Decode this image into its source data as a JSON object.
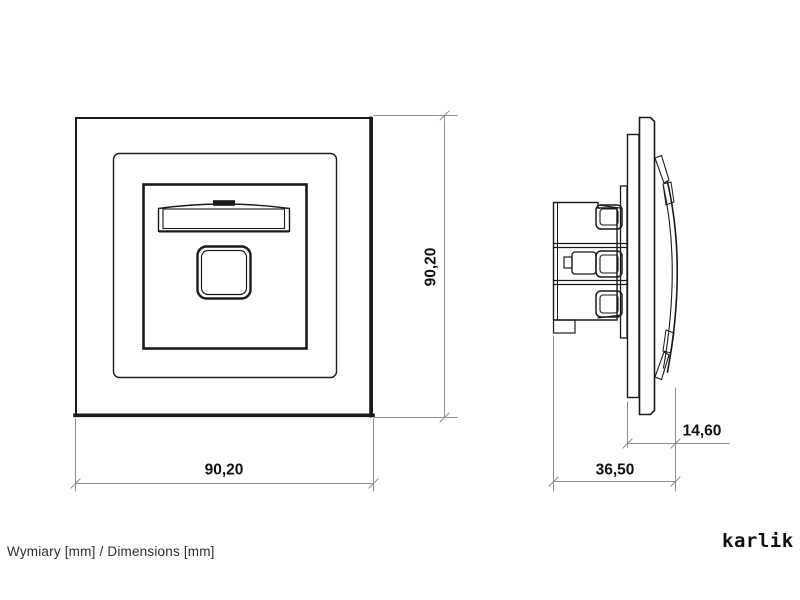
{
  "drawing": {
    "front_view": {
      "width_label": "90,20",
      "height_label": "90,20"
    },
    "side_view": {
      "depth_label": "36,50",
      "protrusion_label": "14,60"
    }
  },
  "footer": {
    "note": "Wymiary [mm] / Dimensions [mm]"
  },
  "brand": {
    "logo_text": "karlik"
  },
  "colors": {
    "background": "#ffffff",
    "drawing_line": "#1a1a1a",
    "dimension_line": "#8f8f8f",
    "text": "#111111"
  }
}
